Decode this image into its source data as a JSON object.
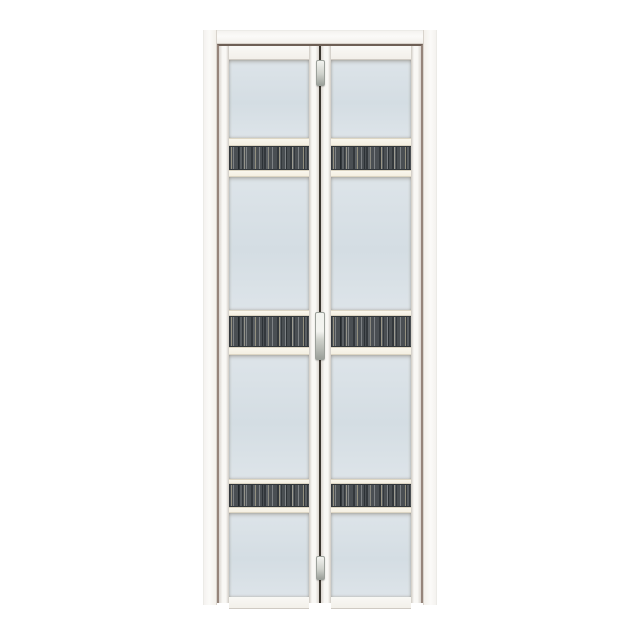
{
  "scene": {
    "type": "product-photo",
    "description": "White aluminium bi-fold door with frosted glass panels and three dark wood-grain accent strips per leaf, shown closed on a plain white background",
    "background": "#ffffff"
  },
  "door": {
    "leaf_count": 2,
    "glass_sections_per_leaf": 4,
    "accent_strips_per_leaf": 3,
    "hardware": [
      "pivot-hinge-top",
      "door-handle",
      "pivot-hinge-bottom"
    ],
    "rows": [
      {
        "part": "rail",
        "h": 14
      },
      {
        "part": "glass",
        "h": 78
      },
      {
        "part": "trim",
        "h": 8
      },
      {
        "part": "strip",
        "h": 22
      },
      {
        "part": "trim",
        "h": 7
      },
      {
        "part": "glass",
        "h": 133
      },
      {
        "part": "trim",
        "h": 6
      },
      {
        "part": "strip",
        "h": 29
      },
      {
        "part": "trim",
        "h": 8
      },
      {
        "part": "glass",
        "h": 124
      },
      {
        "part": "trim",
        "h": 5
      },
      {
        "part": "strip",
        "h": 21
      },
      {
        "part": "trim",
        "h": 6
      },
      {
        "part": "glass",
        "h": 84
      },
      {
        "part": "rail",
        "h": 12
      }
    ]
  },
  "colors": {
    "background": "#ffffff",
    "frame-white": "#fbfaf8",
    "frame-hi": "#f3f1ee",
    "frame-lo": "#f2efe9",
    "frame-edge": "#ecebe7",
    "frame-shade": "#d8d3cc",
    "reveal-taupe": "#95847a",
    "reveal-dark": "#6e5f55",
    "stile-white": "#f9f8f5",
    "stile-shade": "#d9d4ce",
    "stile-edge": "#cfcac3",
    "trim-cream": "#f3eee0",
    "trim-hi": "#fbf8ef",
    "trim-edge": "#ddd6c4",
    "bead-tan": "#b3a89c",
    "glass-light": "#dde4e9",
    "glass-mid": "#d4dde3",
    "strip-base": "#4a4f53",
    "strip-mid": "#5a5f63",
    "strip-light": "#7d8184",
    "strip-dark": "#33383c",
    "meeting-line": "#3b362f",
    "hardware-light": "#f2f3ef",
    "hardware-mid": "#ced1cb",
    "hardware-dark": "#9ba09a"
  }
}
